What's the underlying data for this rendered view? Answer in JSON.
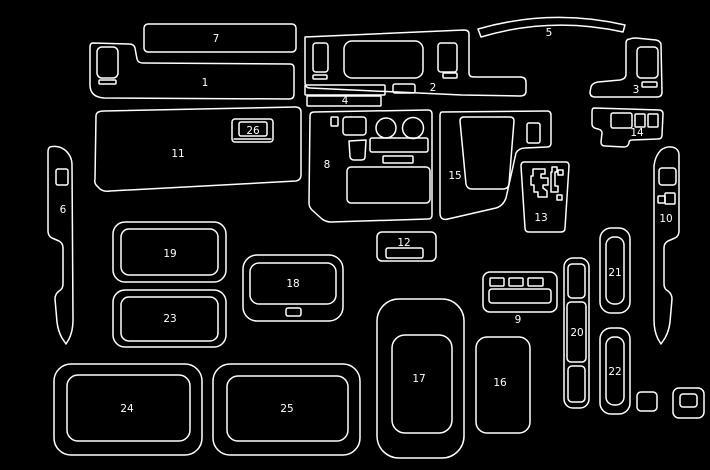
{
  "canvas": {
    "background": "#000000",
    "line_color": "#ffffff",
    "text_color": "#ffffff"
  },
  "parts": [
    {
      "label": "1"
    },
    {
      "label": "2"
    },
    {
      "label": "3"
    },
    {
      "label": "4"
    },
    {
      "label": "5"
    },
    {
      "label": "6"
    },
    {
      "label": "7"
    },
    {
      "label": "8"
    },
    {
      "label": "9"
    },
    {
      "label": "10"
    },
    {
      "label": "11"
    },
    {
      "label": "12"
    },
    {
      "label": "13"
    },
    {
      "label": "14"
    },
    {
      "label": "15"
    },
    {
      "label": "16"
    },
    {
      "label": "17"
    },
    {
      "label": "18"
    },
    {
      "label": "19"
    },
    {
      "label": "20"
    },
    {
      "label": "21"
    },
    {
      "label": "22"
    },
    {
      "label": "23"
    },
    {
      "label": "24"
    },
    {
      "label": "25"
    },
    {
      "label": "26"
    }
  ]
}
